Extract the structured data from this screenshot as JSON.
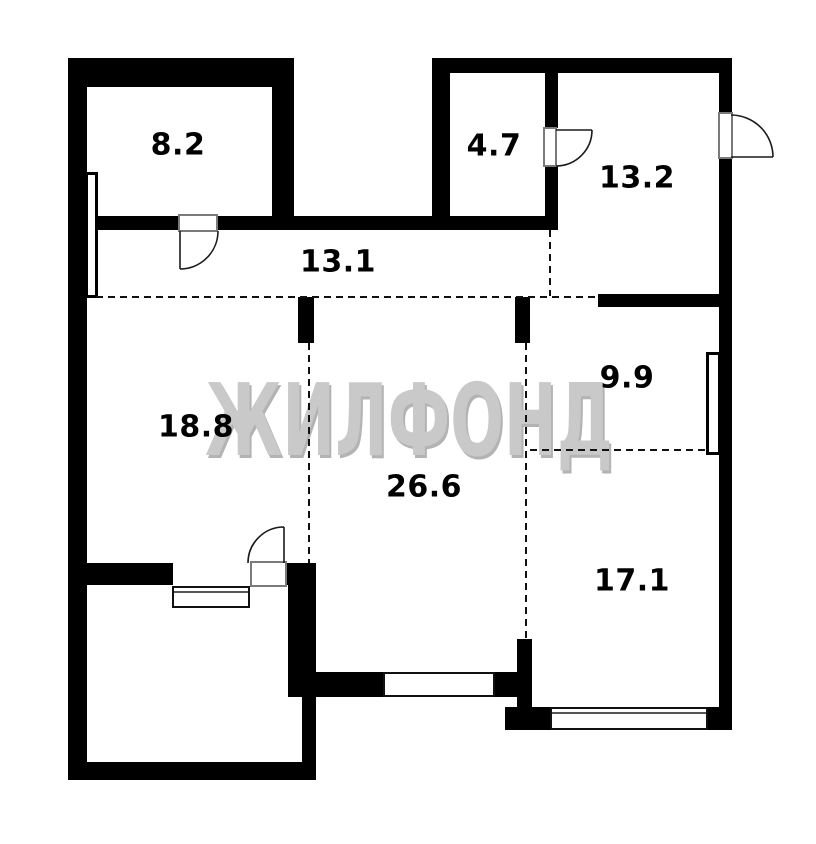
{
  "watermark": {
    "text": "ЖИЛФОНД"
  },
  "rooms": [
    {
      "name": "room-8-2",
      "label": "8.2"
    },
    {
      "name": "room-4-7",
      "label": "4.7"
    },
    {
      "name": "room-13-2",
      "label": "13.2"
    },
    {
      "name": "room-13-1",
      "label": "13.1"
    },
    {
      "name": "room-18-8",
      "label": "18.8"
    },
    {
      "name": "room-9-9",
      "label": "9.9"
    },
    {
      "name": "room-26-6",
      "label": "26.6"
    },
    {
      "name": "room-17-1",
      "label": "17.1"
    }
  ],
  "colors": {
    "wall": "#000000",
    "background": "#ffffff",
    "watermark": "#c9c9c9",
    "watermark_shadow": "#b3b3b3",
    "dashed_line": "#111111"
  }
}
